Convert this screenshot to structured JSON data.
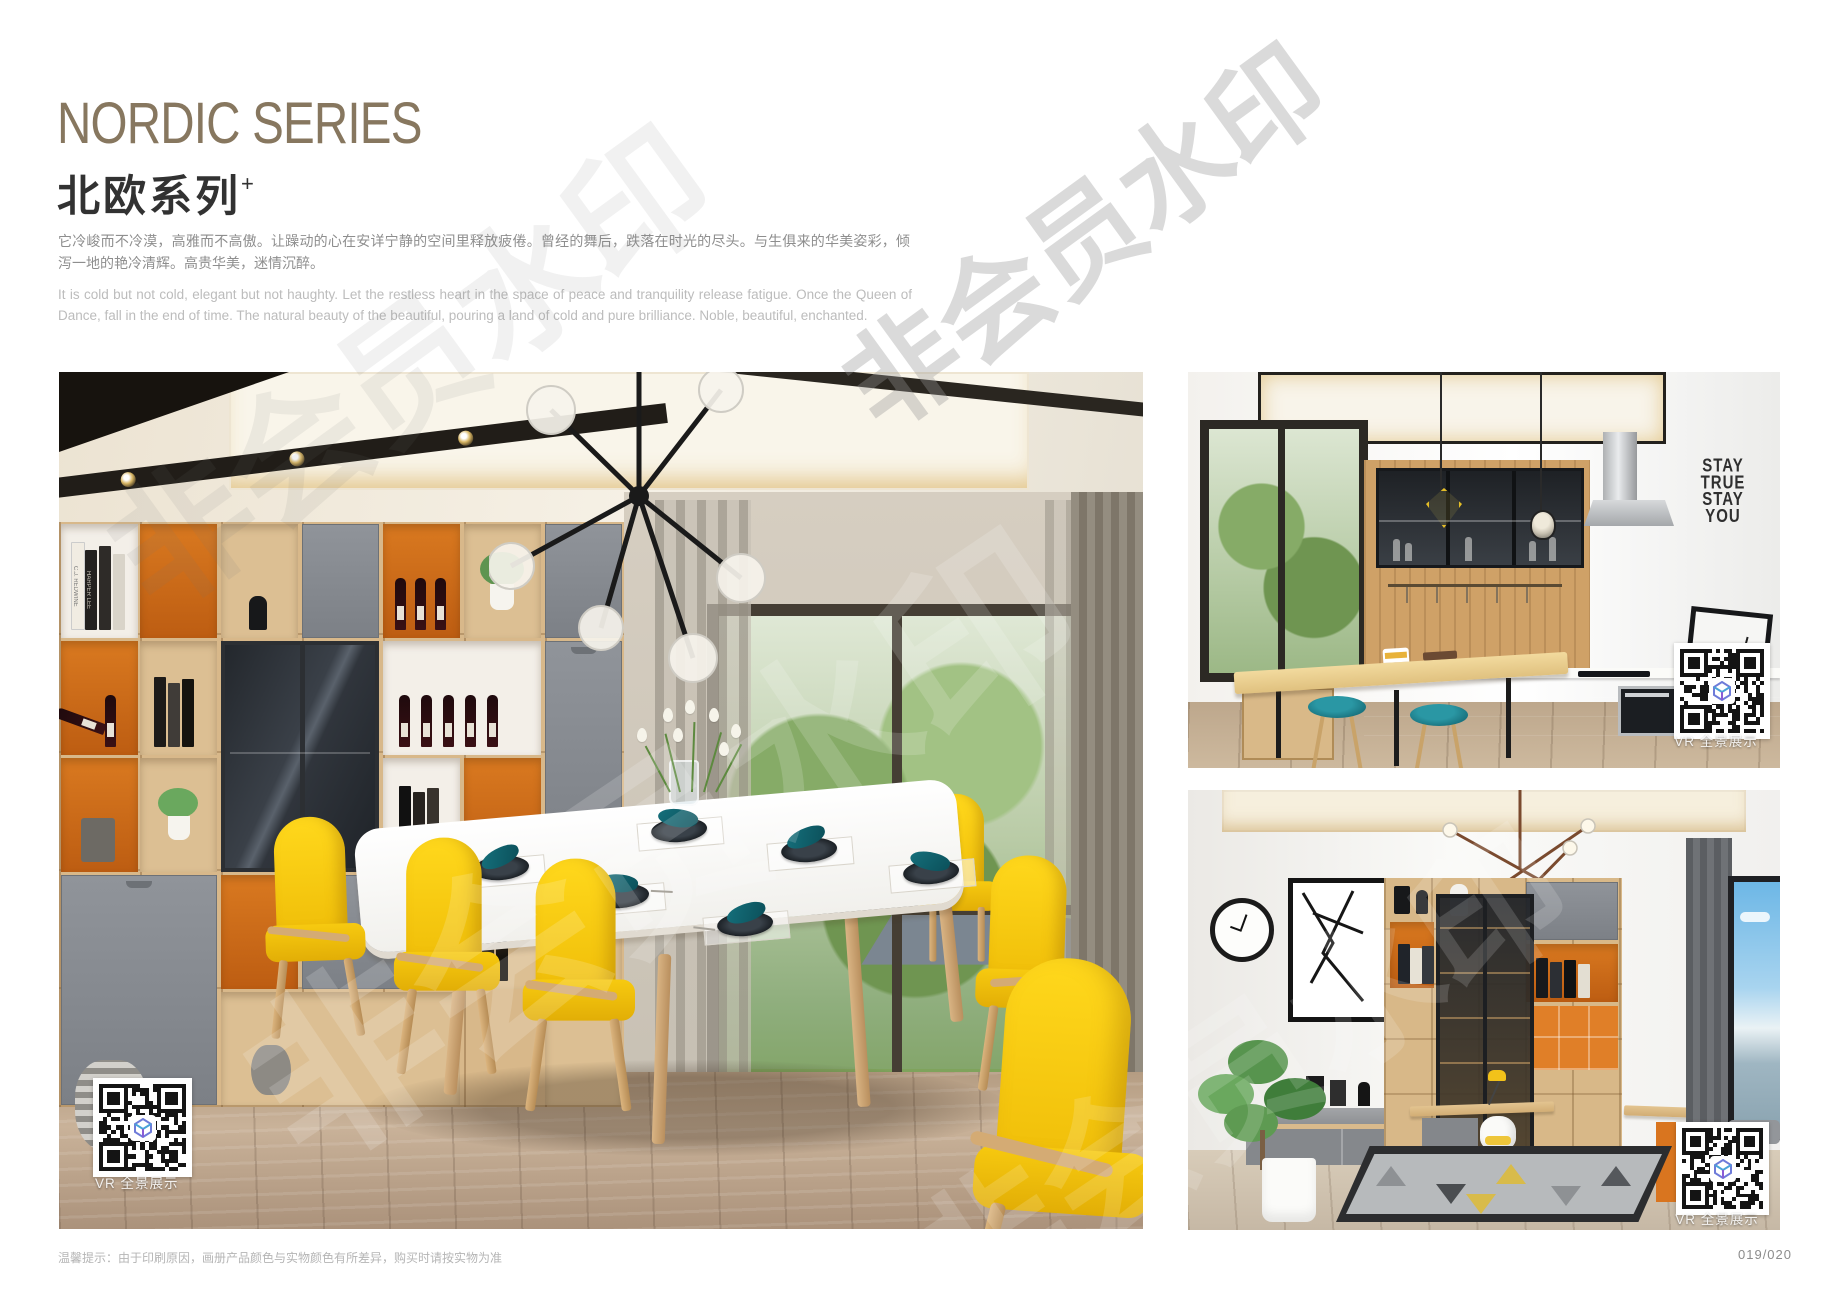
{
  "page": {
    "title_en": "NORDIC SERIES",
    "title_zh": "北欧系列",
    "title_sup": "+",
    "desc_zh": "它冷峻而不冷漠，高雅而不高傲。让躁动的心在安详宁静的空间里释放疲倦。曾经的舞后，跌落在时光的尽头。与生俱来的华美姿彩，倾泻一地的艳冷清辉。高贵华美，迷情沉醉。",
    "desc_en": "It is cold but not cold, elegant but not haughty. Let the restless heart in the space of peace and tranquility release fatigue. Once the Queen of Dance, fall in the end of time. The natural beauty of the beautiful, pouring a land of cold and pure brilliance. Noble, beautiful, enchanted.",
    "footnote": "温馨提示：由于印刷原因，画册产品颜色与实物颜色有所差异，购买时请按实物为准",
    "page_number": "019/020"
  },
  "watermark": {
    "text": "非会员水印"
  },
  "vr": {
    "label": "VR 全景展示"
  },
  "photos": {
    "dining": {
      "books": [
        "C.J. REDWINE",
        "HARPER LEE"
      ]
    },
    "kitchen": {
      "wall_decal": [
        "STAY",
        "TRUE",
        "STAY",
        "YOU"
      ]
    }
  },
  "colors": {
    "title_brown": "#87775F",
    "accent_orange": "#C9661B",
    "chair_yellow": "#F6C91A",
    "stool_teal": "#1E7F8B",
    "wood_light": "#D8B88A",
    "cabinet_gray": "#7E8286"
  }
}
